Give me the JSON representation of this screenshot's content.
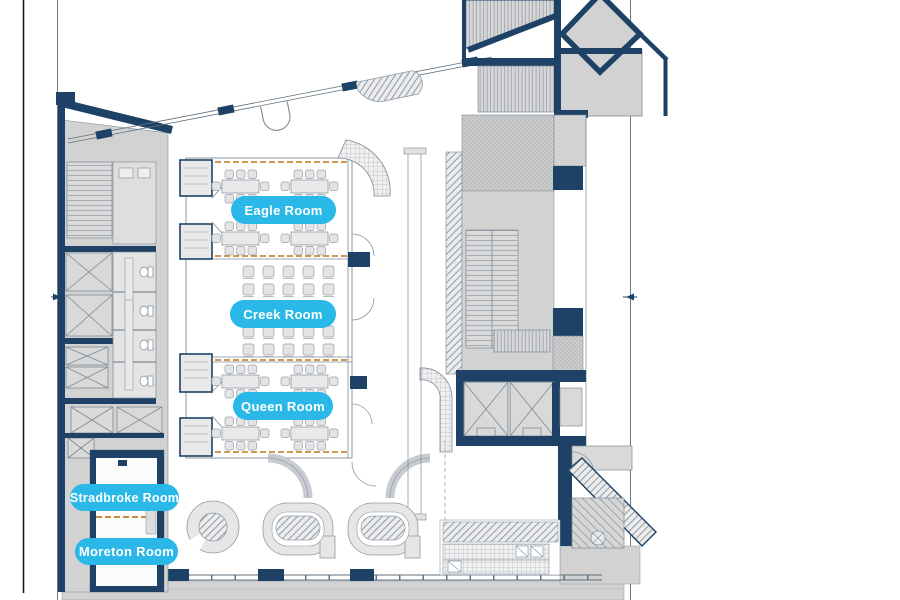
{
  "plan": {
    "type": "building-floor-plan",
    "colors": {
      "wall_navy": "#1d4265",
      "accent_cyan": "#29b8e8",
      "fill_gray": "#d2d2d2",
      "line_gray": "#7d8a94",
      "operable_wall_orange": "#c9893b",
      "label_text": "#ffffff"
    },
    "rooms": [
      {
        "id": "eagle",
        "label": "Eagle Room"
      },
      {
        "id": "creek",
        "label": "Creek Room"
      },
      {
        "id": "queen",
        "label": "Queen Room"
      },
      {
        "id": "stradbroke",
        "label": "Stradbroke Room"
      },
      {
        "id": "moreton",
        "label": "Moreton Room"
      }
    ]
  }
}
